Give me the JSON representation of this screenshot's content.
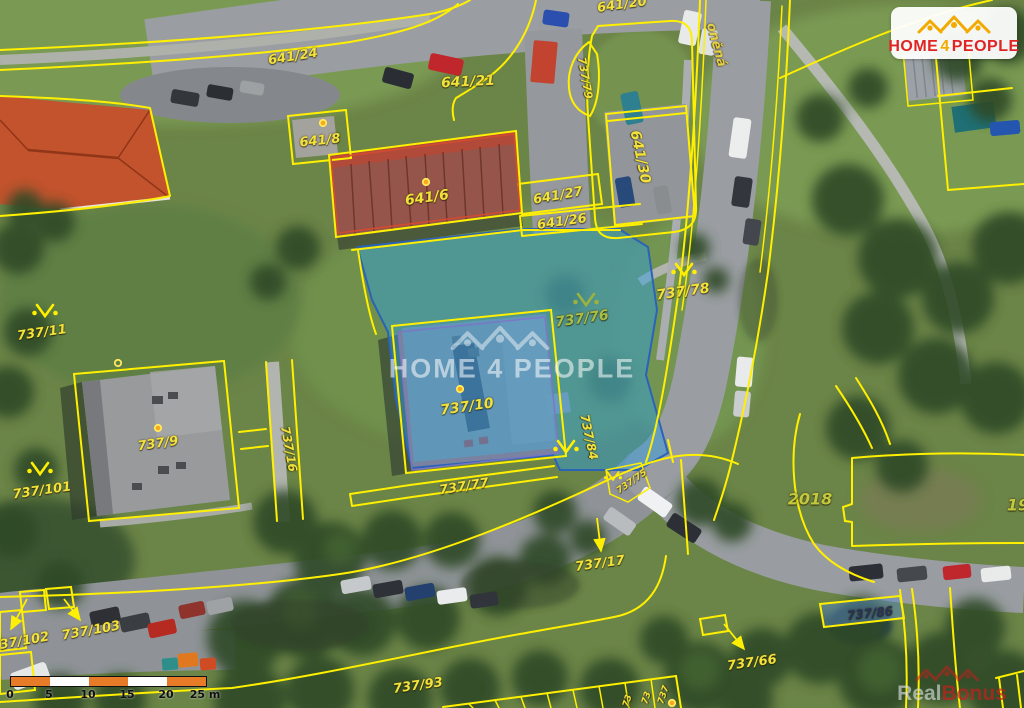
{
  "colors": {
    "parcel_line": "#ffef00",
    "highlight_fill": "#2f9de0",
    "highlight_stroke": "#2b63b8",
    "label_yellow": "#f2e23b",
    "logo_red": "#e02325",
    "logo_yellow": "#f2a900",
    "scalebar_orange": "#e87b28"
  },
  "map": {
    "labels": [
      {
        "text": "641/20",
        "x": 622,
        "y": 5,
        "rot": -8,
        "size": 13
      },
      {
        "text": "641/24",
        "x": 293,
        "y": 57,
        "rot": -9,
        "size": 13
      },
      {
        "text": "641/21",
        "x": 468,
        "y": 82,
        "rot": -3,
        "size": 14
      },
      {
        "text": "737/79",
        "x": 585,
        "y": 78,
        "rot": 80,
        "size": 11
      },
      {
        "text": "641/8",
        "x": 320,
        "y": 141,
        "rot": -6,
        "size": 13
      },
      {
        "text": "641/6",
        "x": 427,
        "y": 198,
        "rot": -8,
        "size": 14
      },
      {
        "text": "641/27",
        "x": 558,
        "y": 196,
        "rot": -10,
        "size": 13
      },
      {
        "text": "641/26",
        "x": 562,
        "y": 222,
        "rot": -8,
        "size": 13
      },
      {
        "text": "641/30",
        "x": 640,
        "y": 157,
        "rot": 78,
        "size": 14
      },
      {
        "text": "oněná",
        "x": 716,
        "y": 45,
        "rot": 75,
        "size": 13,
        "color": "#e3cf45"
      },
      {
        "text": "737/78",
        "x": 683,
        "y": 292,
        "rot": -8,
        "size": 14
      },
      {
        "text": "737/76",
        "x": 582,
        "y": 319,
        "rot": -8,
        "size": 14,
        "color": "#a9bf44"
      },
      {
        "text": "737/11",
        "x": 42,
        "y": 333,
        "rot": -8,
        "size": 13
      },
      {
        "text": "737/9",
        "x": 158,
        "y": 444,
        "rot": -8,
        "size": 13
      },
      {
        "text": "737/16",
        "x": 289,
        "y": 449,
        "rot": 80,
        "size": 12
      },
      {
        "text": "737/101",
        "x": 42,
        "y": 491,
        "rot": -8,
        "size": 13
      },
      {
        "text": "737/10",
        "x": 467,
        "y": 407,
        "rot": -8,
        "size": 14
      },
      {
        "text": "737/84",
        "x": 589,
        "y": 437,
        "rot": 78,
        "size": 12
      },
      {
        "text": "737/77",
        "x": 464,
        "y": 487,
        "rot": -9,
        "size": 13
      },
      {
        "text": "737/75",
        "x": 632,
        "y": 482,
        "rot": -35,
        "size": 9
      },
      {
        "text": "737/17",
        "x": 600,
        "y": 564,
        "rot": -8,
        "size": 13
      },
      {
        "text": "2018",
        "x": 810,
        "y": 499,
        "rot": 0,
        "size": 16,
        "color": "#c2c93f"
      },
      {
        "text": "19",
        "x": 1018,
        "y": 505,
        "rot": 0,
        "size": 16,
        "color": "#c2c93f"
      },
      {
        "text": "737/102",
        "x": 20,
        "y": 642,
        "rot": -10,
        "size": 13
      },
      {
        "text": "737/103",
        "x": 91,
        "y": 631,
        "rot": -10,
        "size": 13
      },
      {
        "text": "737/93",
        "x": 418,
        "y": 686,
        "rot": -8,
        "size": 13
      },
      {
        "text": "737/66",
        "x": 752,
        "y": 663,
        "rot": -8,
        "size": 13
      },
      {
        "text": "737/86",
        "x": 870,
        "y": 613,
        "rot": -6,
        "size": 12,
        "color": "#25335f"
      },
      {
        "text": "737",
        "x": 664,
        "y": 695,
        "rot": -72,
        "size": 9
      },
      {
        "text": "73",
        "x": 647,
        "y": 698,
        "rot": -72,
        "size": 9
      },
      {
        "text": "73",
        "x": 628,
        "y": 701,
        "rot": -72,
        "size": 9
      }
    ],
    "survey_symbols": [
      {
        "x": 45,
        "y": 312
      },
      {
        "x": 40,
        "y": 470
      },
      {
        "x": 586,
        "y": 301,
        "color": "#9cb23c"
      },
      {
        "x": 684,
        "y": 271
      },
      {
        "x": 566,
        "y": 448
      },
      {
        "x": 613,
        "y": 477,
        "scale": 0.7
      }
    ],
    "point_markers": [
      {
        "x": 323,
        "y": 123
      },
      {
        "x": 426,
        "y": 182
      },
      {
        "x": 158,
        "y": 428
      },
      {
        "x": 460,
        "y": 389
      },
      {
        "x": 672,
        "y": 703
      },
      {
        "x": 118,
        "y": 363,
        "ring": true
      }
    ],
    "label_arrows": [
      {
        "x1": 27,
        "y1": 599,
        "x2": 11,
        "y2": 629
      },
      {
        "x1": 64,
        "y1": 599,
        "x2": 80,
        "y2": 620
      },
      {
        "x1": 597,
        "y1": 518,
        "x2": 601,
        "y2": 551
      },
      {
        "x1": 724,
        "y1": 624,
        "x2": 744,
        "y2": 649
      }
    ]
  },
  "logo": {
    "word1": "HOME",
    "word2": "4",
    "word3": "PEOPLE"
  },
  "watermark_center": {
    "text": "HOME 4 PEOPLE"
  },
  "watermark_corner": {
    "part1": "Real",
    "part2": "Bonus"
  },
  "scalebar": {
    "tick_labels": [
      "0",
      "5",
      "10",
      "15",
      "20",
      "25 m"
    ]
  }
}
